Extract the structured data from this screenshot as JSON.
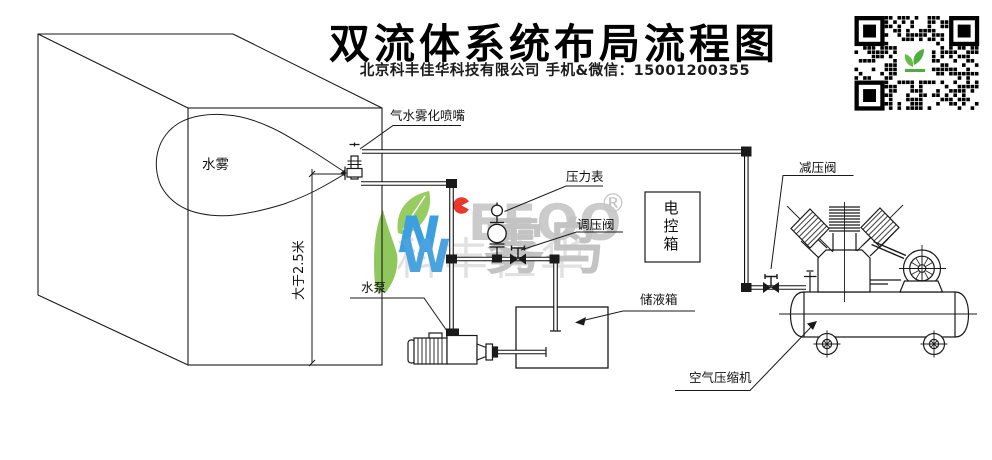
{
  "header": {
    "title": "双流体系统布局流程图",
    "subtitle": "北京科丰佳华科技有限公司 手机&微信：15001200355"
  },
  "labels": {
    "nozzle": "气水雾化喷嘴",
    "mist": "水雾",
    "min_height": "大于2.5米",
    "water_pump": "水泵",
    "pressure_gauge": "压力表",
    "regulating_valve": "调压阀",
    "control_box": "电控箱",
    "reducing_valve": "减压阀",
    "liquid_tank": "储液箱",
    "air_compressor": "空气压缩机"
  },
  "watermark": {
    "letter_n": "N",
    "letter_w": "W",
    "letters": "EEOO",
    "registered": "®",
    "brand_cn": "雾鸟",
    "faint_cn": "科丰佳华"
  },
  "colors": {
    "line": "#1a1a1a",
    "watermark_gray": "#c8c8c8",
    "logo_green": "#8fc75c",
    "logo_blue": "#3d9fe0",
    "logo_red": "#e8392c",
    "qr_logo_green": "#4fae3c"
  }
}
